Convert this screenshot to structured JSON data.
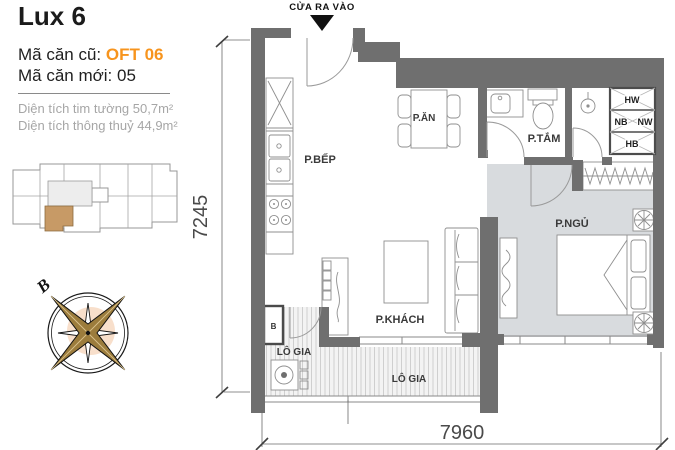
{
  "header": {
    "title": "Lux 6",
    "code_old_label": "Mã căn cũ:",
    "code_old_value": "OFT 06",
    "code_new_label": "Mã căn mới:",
    "code_new_value": "05",
    "area_line1": "Diện tích tim tường 50,7m²",
    "area_line2": "Diện tích thông thuỷ 44,9m²",
    "accent_color": "#F7941D"
  },
  "plan": {
    "entrance_label": "CỬA RA VÀO",
    "rooms": {
      "kitchen": "P.BẾP",
      "dining": "P.ĂN",
      "bathroom": "P.TẮM",
      "bedroom": "P.NGỦ",
      "living": "P.KHÁCH",
      "loggia_left": "LÔ GIA",
      "loggia_bottom": "LÔ GIA"
    },
    "shafts": {
      "hw": "HW",
      "nb": "NB",
      "nw": "NW",
      "hb": "HB"
    },
    "utility_box_label": "B",
    "dimensions": {
      "left": "7245",
      "bottom": "7960"
    },
    "wall_color": "#6F6F6F",
    "bedroom_floor_color": "#D8DBDE"
  },
  "key_plan": {
    "highlight_color": "#C79A66"
  },
  "compass": {
    "north_label": "B",
    "star_color": "#9C7C3C"
  }
}
